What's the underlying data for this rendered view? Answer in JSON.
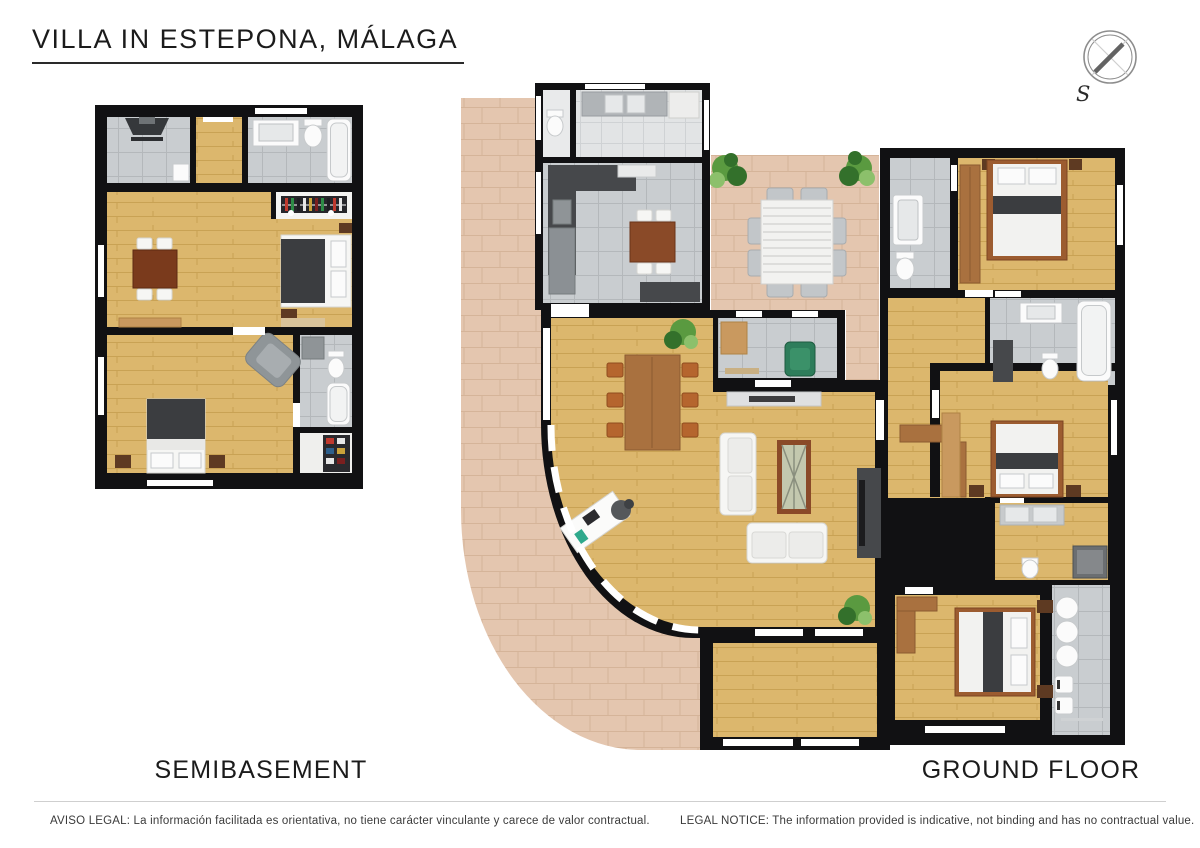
{
  "header": {
    "title": "VILLA IN ESTEPONA, MÁLAGA"
  },
  "compass": {
    "label": "S"
  },
  "plans": [
    {
      "name": "semibasement",
      "label": "SEMIBASEMENT"
    },
    {
      "name": "ground-floor",
      "label": "GROUND FLOOR"
    }
  ],
  "footer": {
    "aviso_legal": "AVISO LEGAL: La información facilitada es orientativa, no tiene carácter vinculante y carece de valor contractual.",
    "legal_notice": "LEGAL NOTICE: The information provided is indicative, not binding and has no contractual value."
  },
  "theme": {
    "wall": "#111113",
    "wood": "#dcb76d",
    "wood-line": "#c9a254",
    "tile": "#c9cdd0",
    "tile-line": "#b4b8bb",
    "tile-light": "#e2e4e5",
    "paving": "#e4c6af",
    "paving-line": "#d5b499",
    "furn-white": "#f6f6f4",
    "dark-unit": "#46484b",
    "bed-dark": "#3b3d40",
    "brown": "#7a3a1c",
    "mid-brown": "#a9713f",
    "light-brown": "#c9995f",
    "nightstand": "#5e3a22",
    "green": "#2e7d5b",
    "plant": "#5a9a40",
    "plant-dark": "#33702b",
    "text-dark": "#1c1c1c",
    "rule": "#cfcfcf"
  }
}
